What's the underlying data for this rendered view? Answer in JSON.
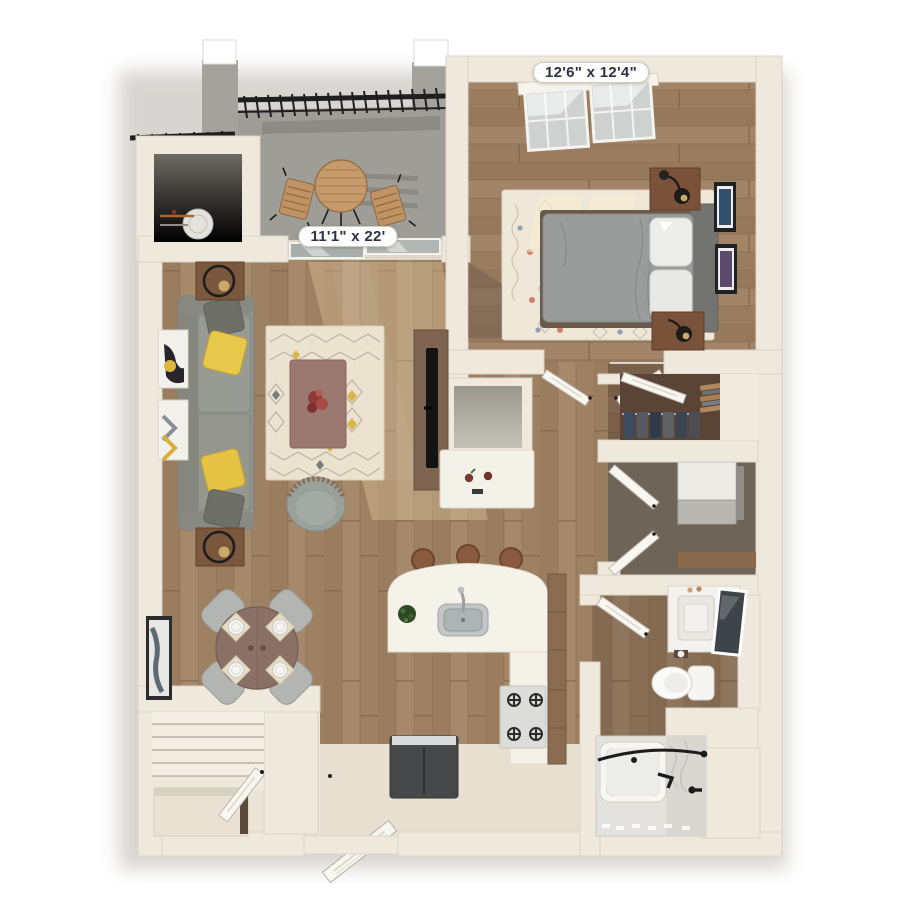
{
  "image": {
    "type": "3d-floor-plan-render",
    "background_color": "#ffffff"
  },
  "floorplan": {
    "dimension_labels": {
      "bedroom": "12'6\" x 12'4\"",
      "living_room": "11'1\" x 22'"
    },
    "colors": {
      "wall": "#efe9dd",
      "wood_floor": "#a18466",
      "balcony_floor": "#9e9d98",
      "rug": "#ece3d0",
      "sofa": "#90928c",
      "accent_pillow": "#e3c33f",
      "coffee_table": "#9b7970",
      "railing": "#1f1f1f",
      "label_text": "#2d3344",
      "entry_floor": "#e7dfd0"
    },
    "rooms": [
      {
        "name": "balcony",
        "objects": [
          "bistro-table",
          "patio-chair-left",
          "patio-chair-right",
          "black-metal-railing",
          "concrete-pillars",
          "storage-door"
        ]
      },
      {
        "name": "utility-closet",
        "objects": [
          "water-heater"
        ]
      },
      {
        "name": "bedroom",
        "dimensions": "12'6\" x 12'4\"",
        "objects": [
          "bed",
          "headboard",
          "pillows",
          "nightstand-top",
          "nightstand-bottom",
          "table-lamps",
          "area-rug",
          "window",
          "wall-art-frames",
          "double-doors"
        ]
      },
      {
        "name": "living-room",
        "dimensions": "11'1\" x 22'",
        "objects": [
          "sofa",
          "throw-pillows",
          "side-table-top",
          "side-table-bottom",
          "lamps",
          "area-rug",
          "coffee-table",
          "flower-centerpiece",
          "tv-console",
          "tv",
          "accent-chair",
          "sliding-glass-door",
          "wall-art-frames"
        ]
      },
      {
        "name": "dining-area",
        "objects": [
          "round-dining-table",
          "dining-chairs",
          "place-settings",
          "wall-art"
        ]
      },
      {
        "name": "kitchen",
        "objects": [
          "curved-island",
          "sink",
          "faucet",
          "plant",
          "bar-stools",
          "range-stove",
          "refrigerator",
          "cabinets",
          "desk-nook-counter",
          "fruit-bowl"
        ]
      },
      {
        "name": "walk-in-closet",
        "objects": [
          "hanging-clothes",
          "shelves",
          "closet-door"
        ]
      },
      {
        "name": "laundry-utility",
        "objects": [
          "appliance",
          "bifold-doors"
        ]
      },
      {
        "name": "bathroom",
        "objects": [
          "vanity-sink",
          "leaning-mirror",
          "toilet",
          "bathtub",
          "shower-rod",
          "black-fixtures",
          "door"
        ]
      },
      {
        "name": "entry",
        "objects": [
          "staircase",
          "stair-half-wall",
          "front-door",
          "closet-door",
          "under-stair-niche"
        ]
      }
    ]
  }
}
